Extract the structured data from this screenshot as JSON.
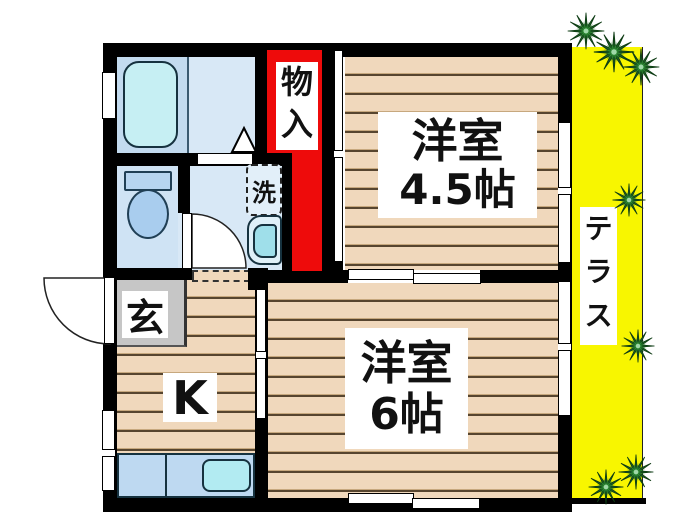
{
  "labels": {
    "storage": "物入",
    "room1_name": "洋室",
    "room1_size": "4.5帖",
    "room2_name": "洋室",
    "room2_size": "6帖",
    "entrance": "玄",
    "kitchen": "K",
    "laundry": "洗",
    "terrace": "テラス"
  },
  "colors": {
    "wall_black": "#000000",
    "storage_red": "#ee0b0b",
    "terrace_yellow": "#f8f600",
    "wood_floor_tan": "#f0d8bc",
    "plank_line_brown": "#57452f",
    "wet_area_blue": "#cfe3f4",
    "wet_area_blue_light": "#d8e8f6",
    "fixture_cyan": "#c6eff3",
    "counter_blue": "#bed9f1",
    "entrance_gray": "#c6c6c6",
    "plant_green": "#1c5e24",
    "label_text": "#111111",
    "label_bg": "#ffffff"
  }
}
